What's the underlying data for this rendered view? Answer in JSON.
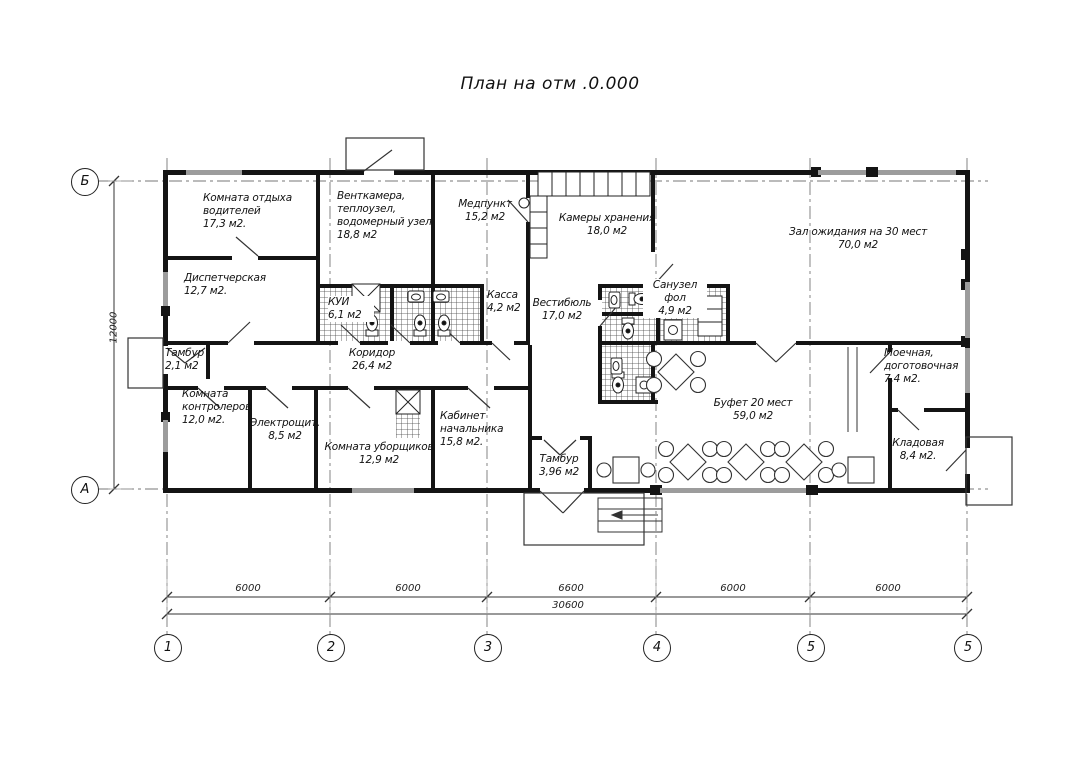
{
  "title": "План на отм .0.000",
  "rooms": [
    {
      "name": "Комната отдыха\nводителей",
      "area": "17,3 м2."
    },
    {
      "name": "Венткамера,\nтеплоузел,\nводомерный узел",
      "area": "18,8 м2"
    },
    {
      "name": "Медпункт",
      "area": "15,2 м2"
    },
    {
      "name": "Камеры хранения",
      "area": "18,0 м2"
    },
    {
      "name": "Зал ожидания на 30 мест",
      "area": "70,0 м2"
    },
    {
      "name": "Диспетчерская",
      "area": "12,7 м2."
    },
    {
      "name": "КУИ",
      "area": "6,1 м2"
    },
    {
      "name": "Касса",
      "area": "4,2 м2"
    },
    {
      "name": "Вестибюль",
      "area": "17,0 м2"
    },
    {
      "name": "Санузел\nфол",
      "area": "4,9 м2"
    },
    {
      "name": "Тамбур",
      "area": "2,1 м2"
    },
    {
      "name": "Коридор",
      "area": "26,4 м2"
    },
    {
      "name": "Комната\nконтролеров",
      "area": "12,0 м2."
    },
    {
      "name": "Электрощит.",
      "area": "8,5 м2"
    },
    {
      "name": "Комната уборщиков",
      "area": "12,9 м2"
    },
    {
      "name": "Кабинет\nначальника",
      "area": "15,8 м2."
    },
    {
      "name": "Тамбур",
      "area": "3,96 м2"
    },
    {
      "name": "Буфет 20 мест",
      "area": "59,0 м2"
    },
    {
      "name": "Моечная,\nдоготовочная",
      "area": "7,4 м2."
    },
    {
      "name": "Кладовая",
      "area": "8,4 м2."
    }
  ],
  "grid": {
    "columns": [
      "1",
      "2",
      "3",
      "4",
      "5",
      "5"
    ],
    "rows": [
      "Б",
      "А"
    ]
  },
  "dimensions": {
    "segments": [
      "6000",
      "6000",
      "6600",
      "6000",
      "6000"
    ],
    "total": "30600",
    "height": "12000"
  },
  "colors": {
    "wall": "#141414",
    "window": "#9c9c9c",
    "thin_line": "#333333",
    "axis_line": "#777777"
  }
}
